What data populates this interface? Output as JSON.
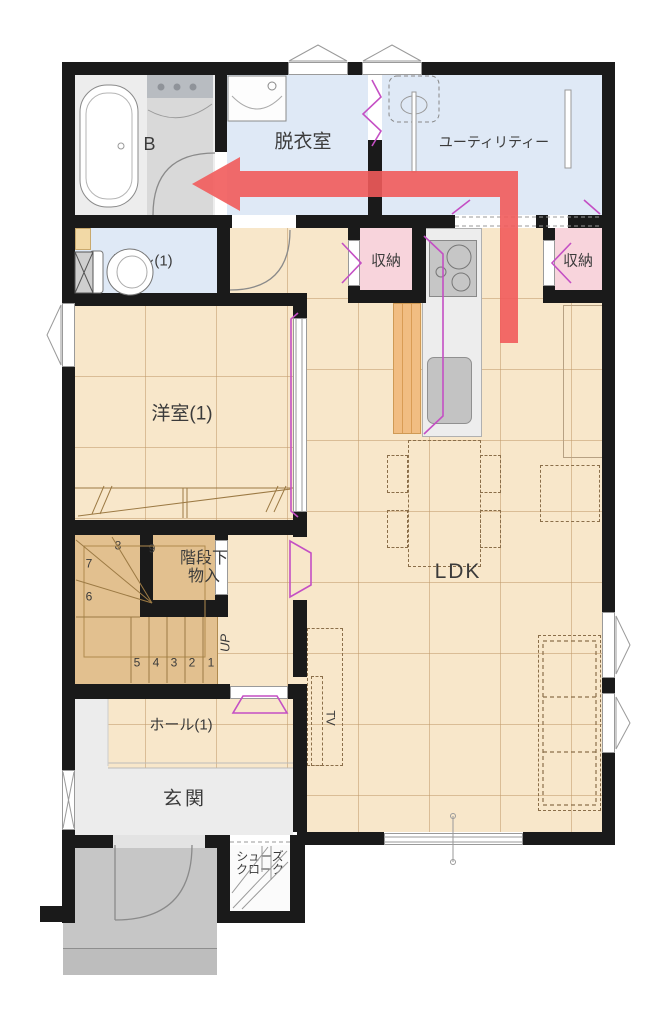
{
  "plan_title": "1F floor plan",
  "rooms": {
    "ub": "UB",
    "dressing_room": "脱衣室",
    "utility": "ユーティリティー",
    "toilet": "トイレ(1)",
    "storage_left": "収納",
    "storage_right": "収納",
    "western_room": "洋室(1)",
    "under_stair_storage_line1": "階段下",
    "under_stair_storage_line2": "物入",
    "ldk": "LDK",
    "hall": "ホール(1)",
    "entrance": "玄関",
    "shoe_closet_line1": "シューズ",
    "shoe_closet_line2": "クローク"
  },
  "stairs": {
    "up": "UP",
    "numbers": [
      "1",
      "2",
      "3",
      "4",
      "5",
      "6",
      "7",
      "8",
      "9"
    ]
  },
  "furniture": {
    "tv": "TV"
  },
  "colors": {
    "wall": "#1a1a1a",
    "floor_beige": "#f8e7ca",
    "floor_blue": "#dfe9f6",
    "floor_pink": "#f8d4dc",
    "floor_ub_gray": "#ededed",
    "stairs_tan": "#e2c08f",
    "entrance_gray": "#ececec",
    "porch_gray": "#c6c6c6",
    "kitchen_cabinet_orange": "#f1bd82",
    "door_highlight_magenta": "#c44fc4",
    "flow_arrow_red": "#f15b5b"
  }
}
